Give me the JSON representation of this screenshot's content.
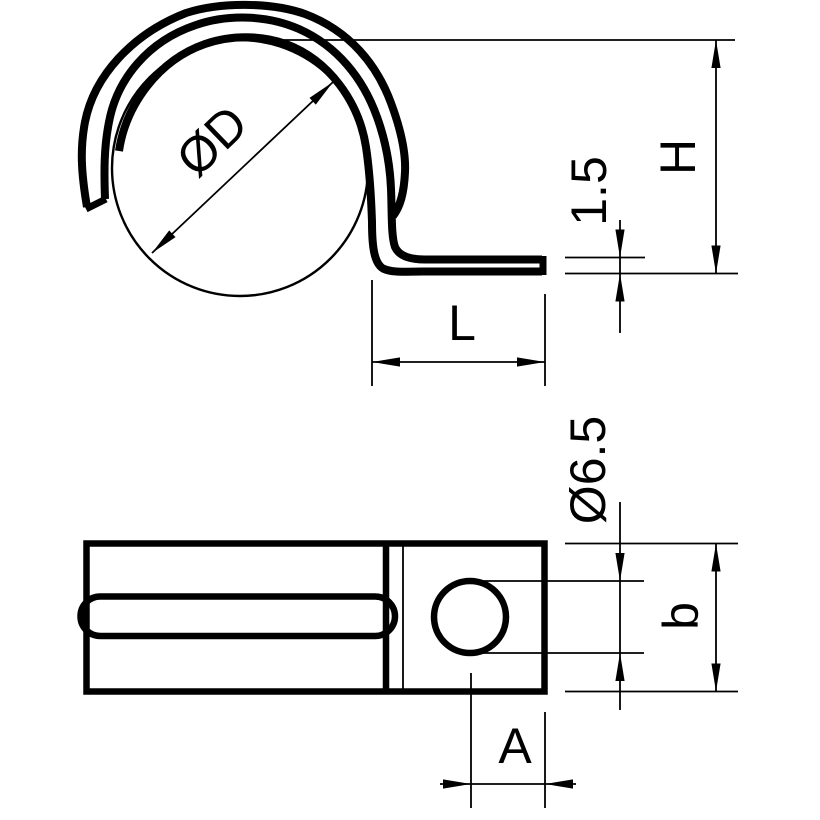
{
  "drawing": {
    "kind": "technical-dimension-drawing",
    "views": {
      "side_view_labels": {
        "pipe_diameter": "ØD",
        "height": "H",
        "material_thickness": "1.5",
        "foot_length": "L"
      },
      "top_view_labels": {
        "hole_diameter": "Ø6.5",
        "clip_width": "b",
        "hole_offset": "A"
      }
    },
    "colors": {
      "line": "#000000",
      "background": "#ffffff"
    }
  }
}
